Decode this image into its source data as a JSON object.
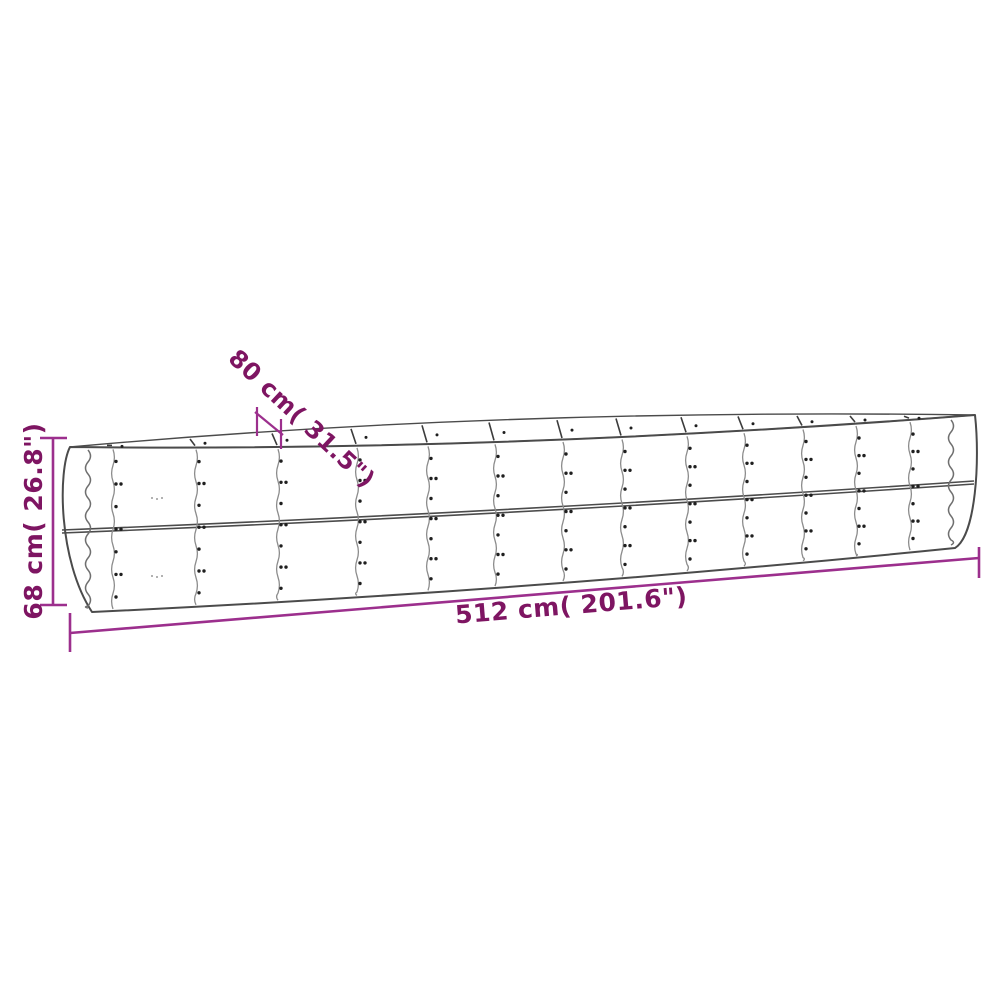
{
  "illustration": {
    "name": "metal-raised-garden-bed-diagram",
    "panel_columns": 14,
    "panel_rows": 2
  },
  "dimensions": {
    "depth": {
      "cm": "80",
      "inches": "31.5",
      "label": "80 cm( 31.5\")"
    },
    "height": {
      "cm": "68",
      "inches": "26.8",
      "label": "68 cm( 26.8\")"
    },
    "length": {
      "cm": "512",
      "inches": "201.6",
      "label": "512 cm( 201.6\")"
    }
  },
  "colors": {
    "background": "#ffffff",
    "outline": "#4b4b4b",
    "seam": "#8c8c8c",
    "rivet": "#1f1f1f",
    "dimension_line": "#9c2f8d",
    "dimension_text": "#7e1562"
  }
}
